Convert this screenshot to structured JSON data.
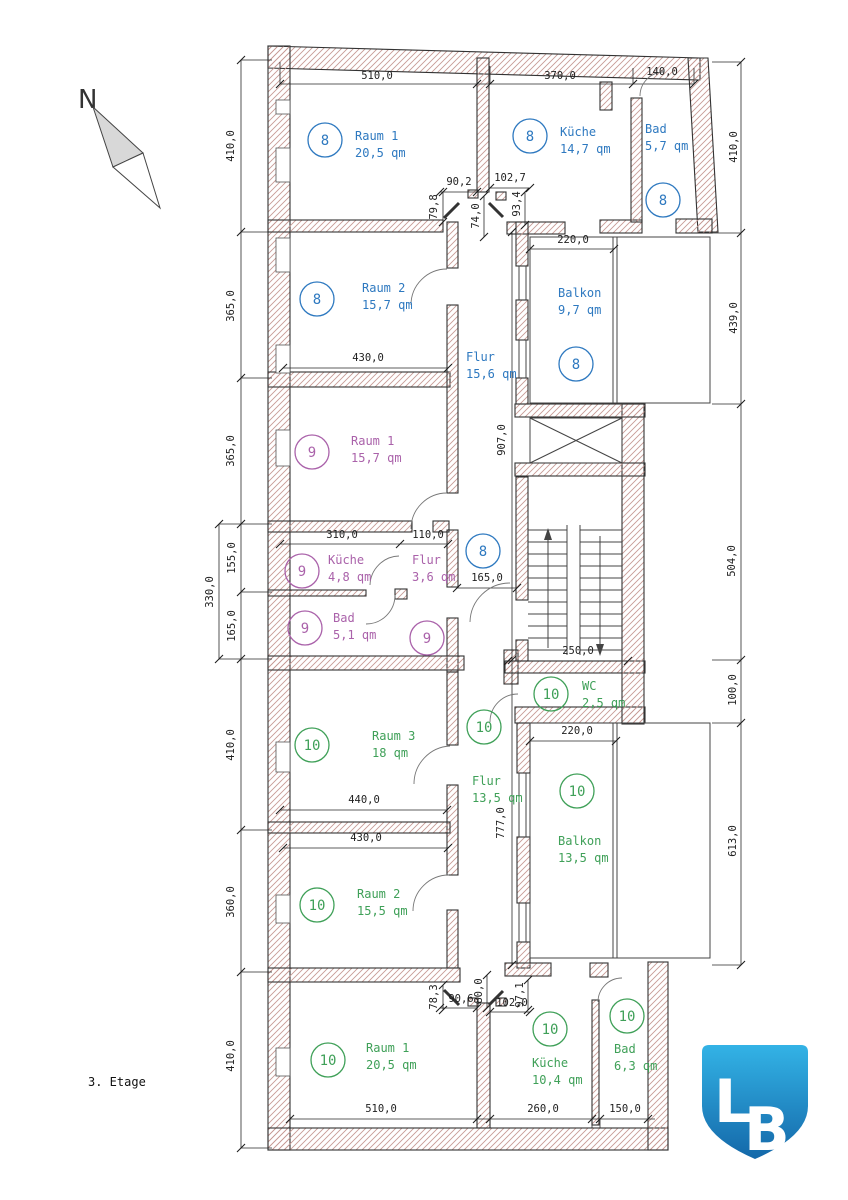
{
  "title": "3. Etage",
  "north": {
    "label": "N"
  },
  "logo": {
    "letter_l": "L",
    "letter_b": "B",
    "color_top": "#33b3e6",
    "color_bottom": "#1468a9"
  },
  "colors": {
    "apt8": "#2e79c0",
    "apt9": "#aa62aa",
    "apt10": "#3fa058",
    "dim_text": "#1f1f1f",
    "wall_outline": "#333333",
    "wall_hatch": "#c79b95"
  },
  "apartments": [
    {
      "number": "8",
      "color": "#2e79c0"
    },
    {
      "number": "9",
      "color": "#aa62aa"
    },
    {
      "number": "10",
      "color": "#3fa058"
    }
  ],
  "rooms": [
    {
      "apt": "8",
      "name": "Raum 1",
      "area": "20,5 qm",
      "circle": [
        325,
        140
      ],
      "text": [
        355,
        140
      ]
    },
    {
      "apt": "8",
      "name": "Küche",
      "area": "14,7 qm",
      "circle": [
        530,
        136
      ],
      "text": [
        560,
        136
      ]
    },
    {
      "apt": "8",
      "name": "Bad",
      "area": "5,7 qm",
      "circle": [
        663,
        200
      ],
      "text": [
        645,
        133
      ]
    },
    {
      "apt": "8",
      "name": "Raum 2",
      "area": "15,7 qm",
      "circle": [
        317,
        299
      ],
      "text": [
        362,
        292
      ]
    },
    {
      "apt": "8",
      "name": "Flur",
      "area": "15,6 qm",
      "circle": null,
      "text": [
        466,
        361
      ]
    },
    {
      "apt": "8",
      "name": "Balkon",
      "area": "9,7 qm",
      "circle": [
        576,
        364
      ],
      "text": [
        558,
        297
      ]
    },
    {
      "apt": "9",
      "name": "Raum 1",
      "area": "15,7 qm",
      "circle": [
        312,
        452
      ],
      "text": [
        351,
        445
      ]
    },
    {
      "apt": "9",
      "name": "Küche",
      "area": "4,8 qm",
      "circle": [
        302,
        571
      ],
      "text": [
        328,
        564
      ]
    },
    {
      "apt": "9",
      "name": "Flur",
      "area": "3,6 qm",
      "circle": null,
      "text": [
        412,
        564
      ]
    },
    {
      "apt": "9",
      "name": "Bad",
      "area": "5,1 qm",
      "circle": [
        305,
        628
      ],
      "text": [
        333,
        622
      ]
    },
    {
      "apt": "10",
      "name": "WC",
      "area": "2,5 qm",
      "circle": [
        551,
        694
      ],
      "text": [
        582,
        690
      ]
    },
    {
      "apt": "10",
      "name": "Raum 3",
      "area": "18 qm",
      "circle": [
        312,
        745
      ],
      "text": [
        372,
        740
      ]
    },
    {
      "apt": "10",
      "name": "Flur",
      "area": "13,5 qm",
      "circle": null,
      "text": [
        472,
        785
      ]
    },
    {
      "apt": "10",
      "name": "Balkon",
      "area": "13,5 qm",
      "circle": [
        577,
        791
      ],
      "text": [
        558,
        845
      ]
    },
    {
      "apt": "10",
      "name": "Raum 2",
      "area": "15,5 qm",
      "circle": [
        317,
        905
      ],
      "text": [
        357,
        898
      ]
    },
    {
      "apt": "10",
      "name": "Raum 1",
      "area": "20,5 qm",
      "circle": [
        328,
        1060
      ],
      "text": [
        366,
        1052
      ]
    },
    {
      "apt": "10",
      "name": "Küche",
      "area": "10,4 qm",
      "circle": [
        550,
        1029
      ],
      "text": [
        532,
        1067
      ]
    },
    {
      "apt": "10",
      "name": "Bad",
      "area": "6,3 qm",
      "circle": [
        627,
        1016
      ],
      "text": [
        614,
        1053
      ]
    }
  ],
  "extra_circles": [
    {
      "apt": "8",
      "pos": [
        483,
        551
      ]
    },
    {
      "apt": "9",
      "pos": [
        427,
        638
      ]
    },
    {
      "apt": "10",
      "pos": [
        484,
        727
      ]
    }
  ],
  "dimensions": [
    {
      "t": "510,0",
      "x": 377,
      "y": 79,
      "r": 0
    },
    {
      "t": "370,0",
      "x": 560,
      "y": 79,
      "r": 0
    },
    {
      "t": "140,0",
      "x": 662,
      "y": 75,
      "r": 0
    },
    {
      "t": "410,0",
      "x": 234,
      "y": 146,
      "r": 90
    },
    {
      "t": "365,0",
      "x": 234,
      "y": 306,
      "r": 90
    },
    {
      "t": "365,0",
      "x": 234,
      "y": 451,
      "r": 90
    },
    {
      "t": "155,0",
      "x": 235,
      "y": 558,
      "r": 90
    },
    {
      "t": "165,0",
      "x": 235,
      "y": 626,
      "r": 90
    },
    {
      "t": "330,0",
      "x": 213,
      "y": 592,
      "r": 90
    },
    {
      "t": "410,0",
      "x": 234,
      "y": 745,
      "r": 90
    },
    {
      "t": "360,0",
      "x": 234,
      "y": 902,
      "r": 90
    },
    {
      "t": "410,0",
      "x": 234,
      "y": 1056,
      "r": 90
    },
    {
      "t": "410,0",
      "x": 737,
      "y": 147,
      "r": 90
    },
    {
      "t": "439,0",
      "x": 737,
      "y": 318,
      "r": 90
    },
    {
      "t": "504,0",
      "x": 735,
      "y": 561,
      "r": 90
    },
    {
      "t": "100,0",
      "x": 736,
      "y": 690,
      "r": 90
    },
    {
      "t": "613,0",
      "x": 736,
      "y": 841,
      "r": 90
    },
    {
      "t": "907,0",
      "x": 505,
      "y": 440,
      "r": 90
    },
    {
      "t": "777,0",
      "x": 504,
      "y": 823,
      "r": 90
    },
    {
      "t": "220,0",
      "x": 573,
      "y": 243,
      "r": 0
    },
    {
      "t": "430,0",
      "x": 368,
      "y": 361,
      "r": 0
    },
    {
      "t": "310,0",
      "x": 342,
      "y": 538,
      "r": 0
    },
    {
      "t": "110,0",
      "x": 428,
      "y": 538,
      "r": 0
    },
    {
      "t": "165,0",
      "x": 487,
      "y": 581,
      "r": 0
    },
    {
      "t": "250,0",
      "x": 578,
      "y": 654,
      "r": 0
    },
    {
      "t": "220,0",
      "x": 577,
      "y": 734,
      "r": 0
    },
    {
      "t": "440,0",
      "x": 364,
      "y": 803,
      "r": 0
    },
    {
      "t": "430,0",
      "x": 366,
      "y": 841,
      "r": 0
    },
    {
      "t": "510,0",
      "x": 381,
      "y": 1112,
      "r": 0
    },
    {
      "t": "260,0",
      "x": 543,
      "y": 1112,
      "r": 0
    },
    {
      "t": "150,0",
      "x": 625,
      "y": 1112,
      "r": 0
    },
    {
      "t": "90,2",
      "x": 459,
      "y": 185,
      "r": 0
    },
    {
      "t": "102,7",
      "x": 510,
      "y": 181,
      "r": 0
    },
    {
      "t": "79,8",
      "x": 437,
      "y": 207,
      "r": 90
    },
    {
      "t": "74,0",
      "x": 479,
      "y": 216,
      "r": 90
    },
    {
      "t": "93,4",
      "x": 520,
      "y": 204,
      "r": 90
    },
    {
      "t": "78,3",
      "x": 437,
      "y": 997,
      "r": 90
    },
    {
      "t": "90,6",
      "x": 461,
      "y": 1002,
      "r": 0
    },
    {
      "t": "80,0",
      "x": 482,
      "y": 991,
      "r": 90
    },
    {
      "t": "102,0",
      "x": 512,
      "y": 1006,
      "r": 0
    },
    {
      "t": "97,1",
      "x": 523,
      "y": 995,
      "r": 90
    }
  ]
}
